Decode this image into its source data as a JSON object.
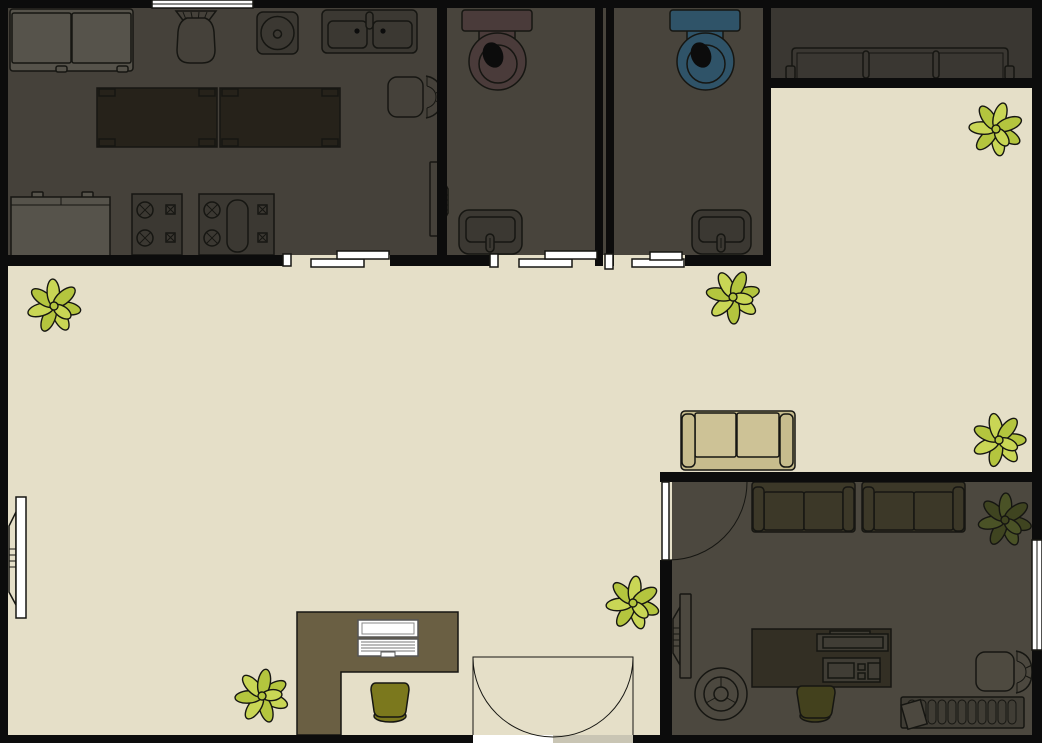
{
  "palette": {
    "wall": "#0c0c0c",
    "beige": "#e5dfc8",
    "kitchen": "#45413a",
    "bath": "#48443c",
    "strip": "#3a3732",
    "office": "#4c483f",
    "outline": "#161612",
    "gray": "#56534b",
    "appliance": "#3b3832",
    "tabletop": "#26221a",
    "toiletbrown": "#4a3b3a",
    "toiletblue": "#2f5368",
    "sofatan": "#c7bc8d",
    "sofacushion": "#cdc296",
    "sofaoffice": "#3c3828",
    "deskbrown": "#6a5f43",
    "chairolive": "#7b781d",
    "officedesk": "#332f24",
    "officedevice": "#403d35",
    "officechair": "#43411d",
    "chairgray": "#4e4a40",
    "planta": "#b4c53e",
    "plantb": "#c9d655",
    "darka": "#3f4420",
    "darkb": "#4a5226",
    "white": "#ffffff",
    "doorgray": "#c9c5b4"
  },
  "rooms": {
    "kitchen": {
      "name": "kitchen",
      "furniture": [
        "loveseat",
        "wicker-chair",
        "round-sink-unit",
        "double-basin-sink",
        "prep-table-1",
        "prep-table-2",
        "side-chair",
        "wall-tv",
        "counter-cabinet",
        "stove-1",
        "stove-2"
      ],
      "door": "sliding-door",
      "window": "top-wall-window"
    },
    "bathroom-1": {
      "name": "bathroom-1",
      "furniture": [
        "toilet-brown",
        "wash-basin"
      ],
      "door": "sliding-door"
    },
    "bathroom-2": {
      "name": "bathroom-2",
      "furniture": [
        "toilet-blue",
        "wash-basin"
      ],
      "door": "sliding-door"
    },
    "waiting-nook": {
      "name": "waiting-nook",
      "furniture": [
        "bench"
      ]
    },
    "lobby": {
      "name": "lobby",
      "furniture": [
        "loveseat-tan",
        "reception-desk",
        "laptop",
        "desk-chair-olive",
        "wall-tv",
        "plants-x6"
      ],
      "door": "double-swing-door"
    },
    "office": {
      "name": "office",
      "furniture": [
        "loveseat-1",
        "loveseat-2",
        "wall-tv",
        "floor-fan",
        "desk",
        "monitor",
        "printer-unit",
        "desk-chair",
        "side-chair",
        "radiator",
        "tilted-box",
        "plant-dark"
      ],
      "door": "swing-door",
      "window": "right-wall-window"
    }
  },
  "plants": {
    "light_count": 6,
    "dark_count": 1
  }
}
